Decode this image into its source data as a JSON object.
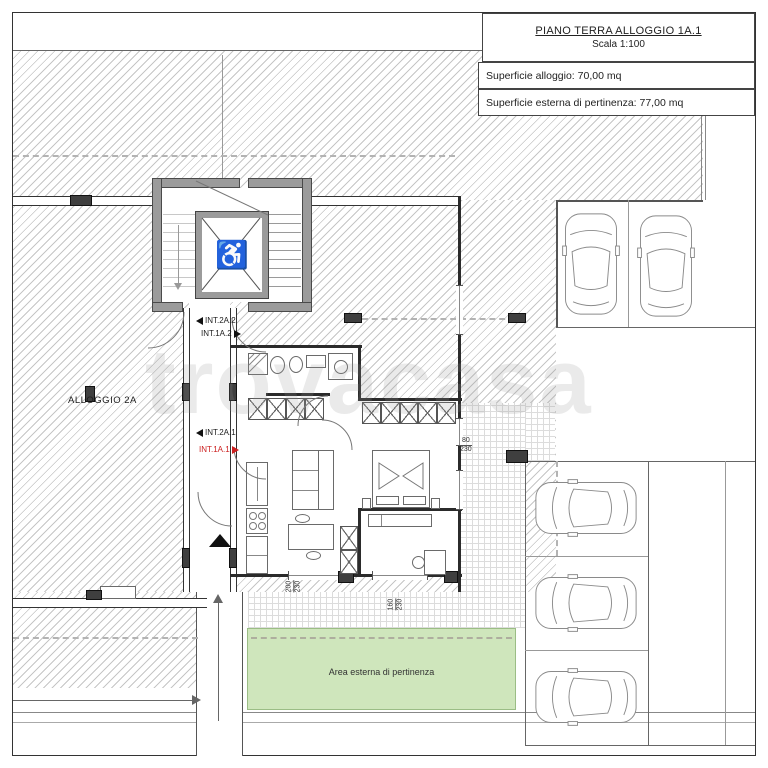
{
  "title_block": {
    "title": "PIANO TERRA ALLOGGIO 1A.1",
    "scale": "Scala 1:100",
    "area_row": "Superficie alloggio: 70,00 mq",
    "external_row": "Superficie esterna di pertinenza: 77,00 mq"
  },
  "unit_labels": {
    "allogio_2a": "ALLOGGIO 2A",
    "int_2a_2": "INT.2A.2",
    "int_1a_2": "INT.1A.2",
    "int_2a_1": "INT.2A.1",
    "int_1a_1": "INT.1A.1"
  },
  "areas": {
    "green_label": "Area esterna di pertinenza"
  },
  "dimensions": {
    "window_right_w": "80",
    "window_right_h": "230",
    "window_bottom1_w": "200",
    "window_bottom1_h": "230",
    "window_bottom2_w": "160",
    "window_bottom2_h": "230"
  },
  "watermark": "trovacasa",
  "icons": {
    "wheelchair": "♿"
  },
  "colors": {
    "green_area": "#cfe6bc",
    "highlight_red": "#cc2020",
    "wall_gray": "#9b9b9b",
    "hatch_line": "#c6c6c6"
  }
}
